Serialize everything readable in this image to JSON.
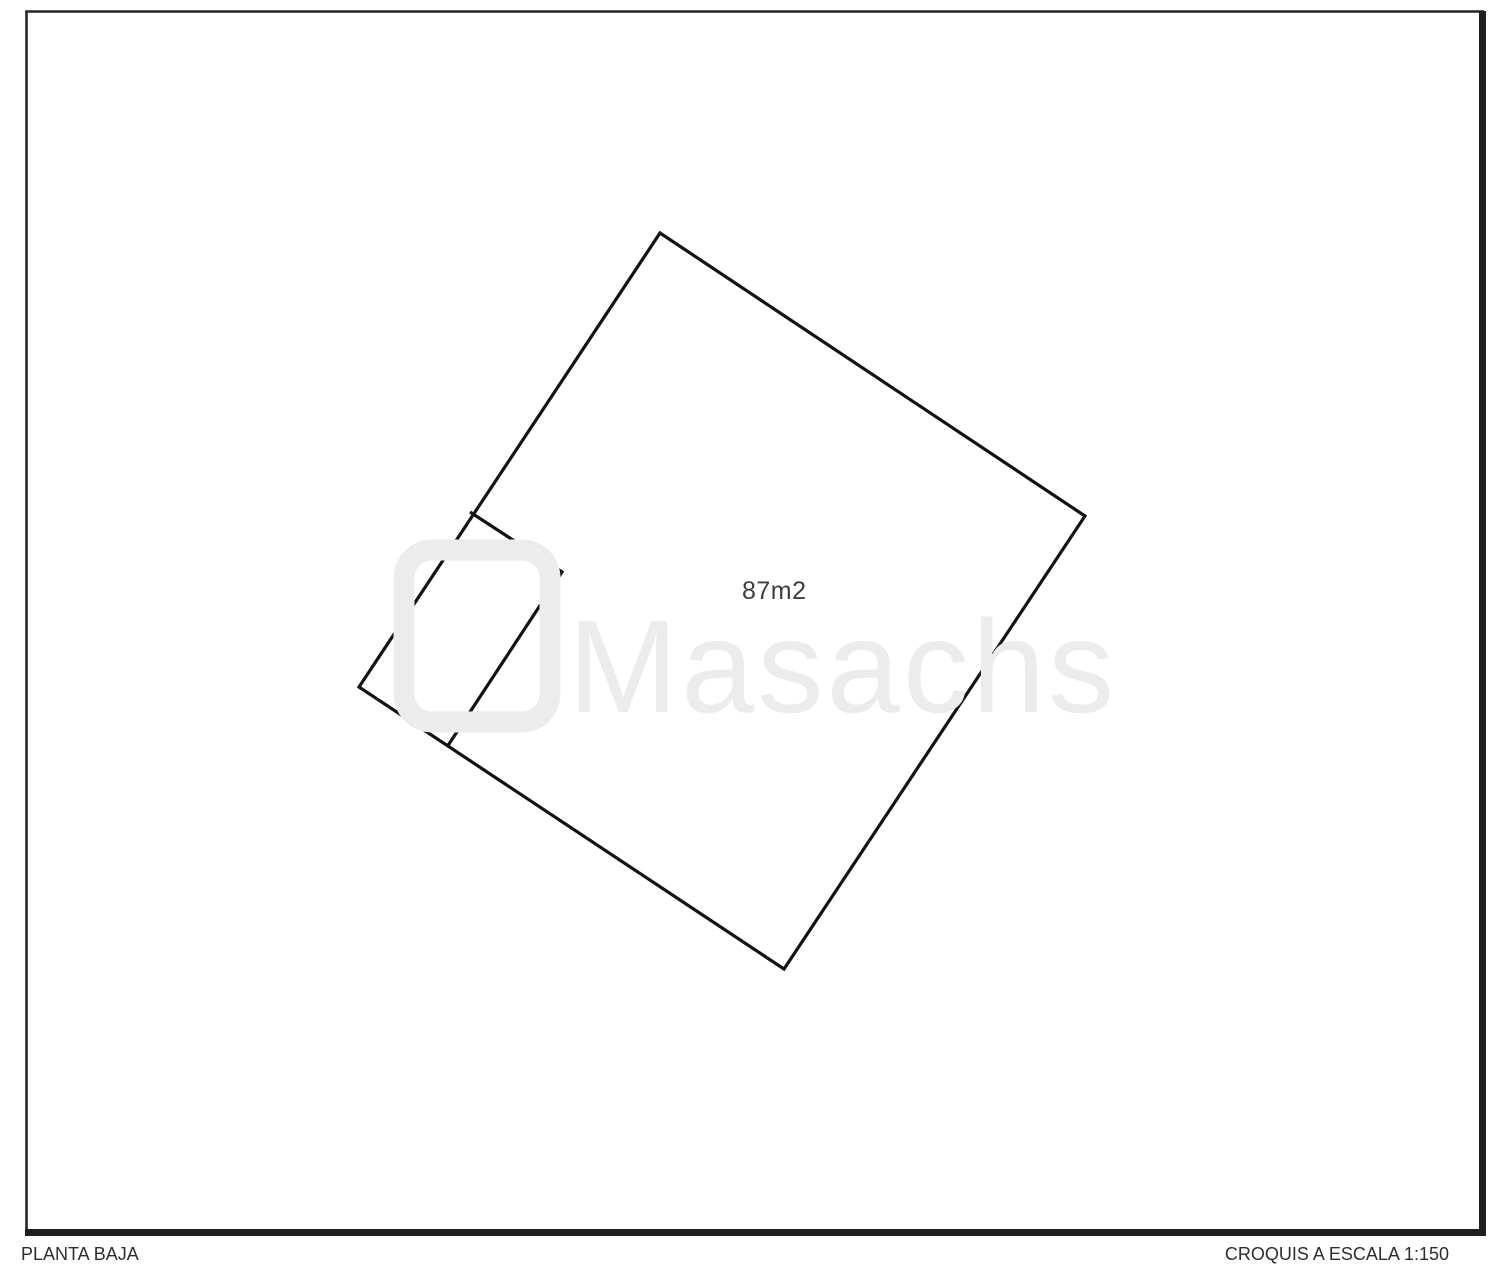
{
  "page": {
    "kind": "floorplan-sketch",
    "background": "#ffffff",
    "frame_color": "#262626"
  },
  "plan": {
    "line_color": "#121212",
    "area_label": "87m2",
    "main_room_vertices": [
      [
        660,
        233
      ],
      [
        1085,
        516
      ],
      [
        784,
        969
      ],
      [
        359,
        687
      ]
    ],
    "annex_partition_vertices": [
      [
        470,
        512
      ],
      [
        562,
        572
      ],
      [
        447,
        747
      ]
    ]
  },
  "watermark": {
    "text": "Masachs",
    "color": "#ececec"
  },
  "footer": {
    "left": "PLANTA BAJA",
    "right": "CROQUIS A ESCALA 1:150"
  }
}
